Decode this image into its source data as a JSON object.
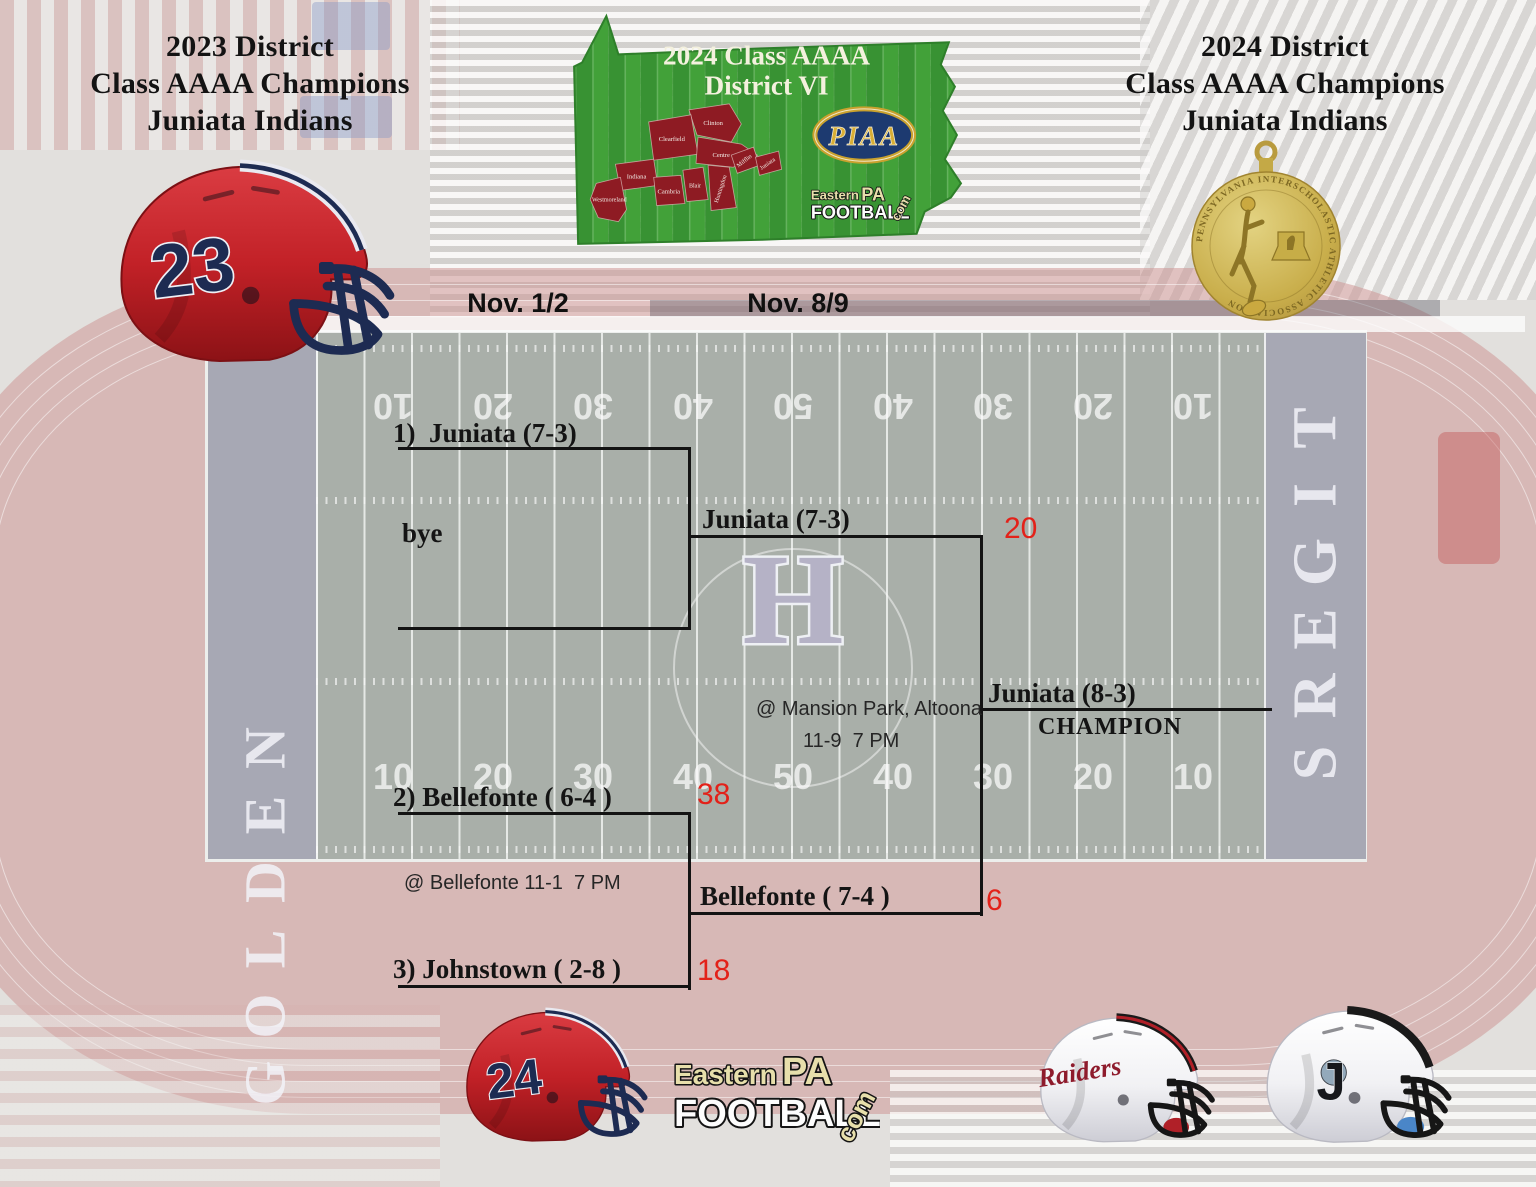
{
  "colors": {
    "score_red": "#e32119",
    "bracket_line_black": "#131313",
    "map_green": "#3f9c37",
    "county_red": "#8e1b23",
    "piaa_navy": "#1d3a70",
    "piaa_gold": "#d9ae35",
    "medal_gold": "#c9ae4b",
    "helmet_red": "#c22127",
    "helmet_navy": "#1d2b52",
    "field_gray_green": "#a9afa9",
    "track_pink": "#ce9a97"
  },
  "titles": {
    "left": {
      "line1": "2023 District",
      "line2": "Class AAAA Champions",
      "line3": "Juniata Indians"
    },
    "right": {
      "line1": "2024 District",
      "line2": "Class AAAA Champions",
      "line3": "Juniata Indians"
    }
  },
  "map": {
    "title_line1": "2024 Class AAAA",
    "title_line2": "District VI",
    "piaa": "PIAA",
    "counties": [
      "Clinton",
      "Clearfield",
      "Centre",
      "Indiana",
      "Cambria",
      "Blair",
      "Huntingdon",
      "Mifflin",
      "Juniata",
      "Westmoreland"
    ]
  },
  "brand": {
    "eastern": "Eastern",
    "pa": "PA",
    "football": "FOOTBALL",
    "com": "com"
  },
  "medal": {
    "ring_text": "PENNSYLVANIA  INTERSCHOLASTIC  ATHLETIC  ASSOCIATION"
  },
  "bracket": {
    "round1_date": "Nov. 1/2",
    "round2_date": "Nov. 8/9",
    "seed1": "1)  Juniata (7-3)",
    "bye": "bye",
    "finalist1": "Juniata (7-3)",
    "finalist1_score": "20",
    "final_venue": "@ Mansion Park, Altoona",
    "final_time": "11-9  7 PM",
    "champion_team": "Juniata (8-3)",
    "champion_label": "CHAMPION",
    "seed2": "2) Bellefonte ( 6-4 )",
    "seed2_score": "38",
    "semifinal_venue": "@ Bellefonte 11-1  7 PM",
    "finalist2": "Bellefonte ( 7-4 )",
    "finalist2_score": "6",
    "seed3": "3) Johnstown ( 2-8 )",
    "seed3_score": "18"
  },
  "field": {
    "left_endzone": "GOLDEN",
    "right_endzone": "TIGERS",
    "center_letter": "H",
    "yard_numbers": [
      "10",
      "20",
      "30",
      "40",
      "50",
      "40",
      "30",
      "20",
      "10"
    ]
  },
  "helmets": {
    "year2023_number": "23",
    "year2024_number": "24",
    "raiders_script": "Raiders",
    "johnstown_letter": "J"
  }
}
